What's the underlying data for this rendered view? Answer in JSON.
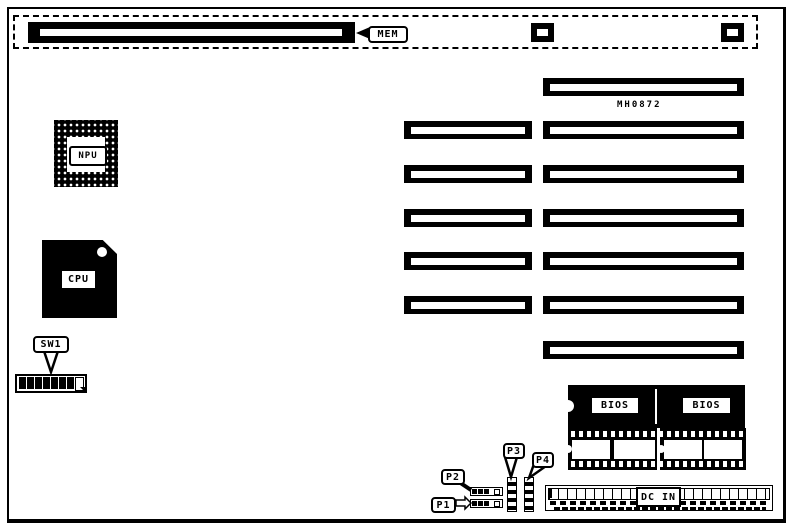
{
  "colors": {
    "ink": "#000000",
    "paper": "#ffffff"
  },
  "part_number": "MH0872",
  "callouts": {
    "mem": "MEM",
    "sw1": "SW1",
    "p1": "P1",
    "p2": "P2",
    "p3": "P3",
    "p4": "P4",
    "dc_in": "DC IN"
  },
  "chips": {
    "npu": "NPU",
    "cpu": "CPU",
    "bios_left": "BIOS",
    "bios_right": "BIOS"
  },
  "expansion_slots": {
    "left_column_count": 5,
    "right_column_count": 7
  },
  "dip_switch": {
    "positions": 8,
    "pattern": [
      "on",
      "on",
      "on",
      "on",
      "on",
      "on",
      "on",
      "off"
    ]
  },
  "memory_bank": {
    "long_slot_count": 1,
    "small_socket_count": 2
  }
}
